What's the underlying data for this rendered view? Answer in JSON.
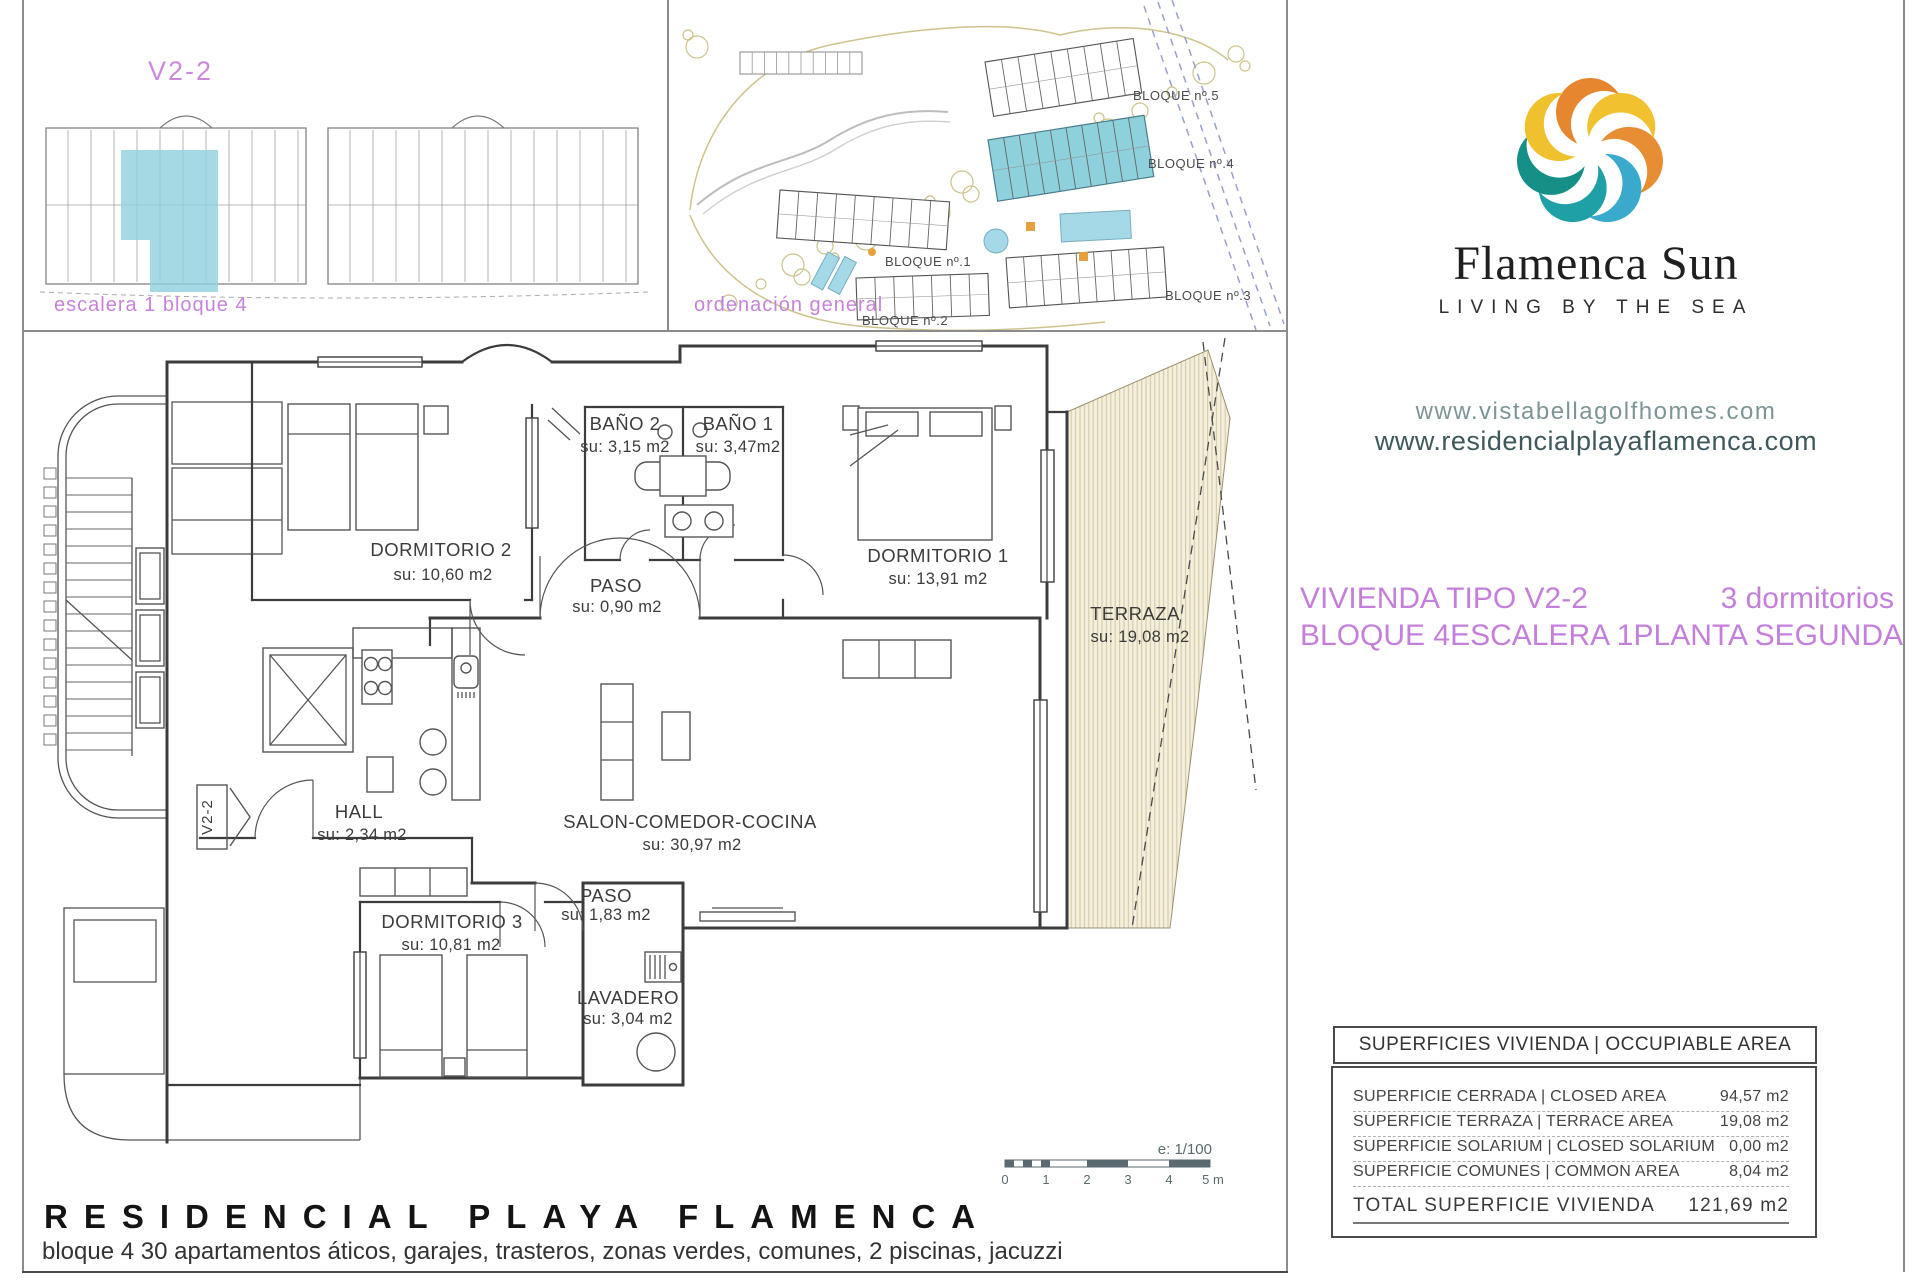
{
  "panel_unit": {
    "title": "V2-2",
    "caption": "escalera 1 bloque 4"
  },
  "panel_site": {
    "caption": "ordenación general",
    "blocks": {
      "b1": "BLOQUE nº.1",
      "b2": "BLOQUE nº.2",
      "b3": "BLOQUE nº.3",
      "b4": "BLOQUE nº.4",
      "b5": "BLOQUE nº.5"
    }
  },
  "brand": {
    "name": "Flamenca Sun",
    "tagline": "LIVING BY THE SEA",
    "url1": "www.vistabellagolfhomes.com",
    "url2": "www.residencialplayaflamenca.com"
  },
  "unit_info": {
    "type_label": "VIVIENDA TIPO V2-2",
    "bedrooms": "3 dormitorios",
    "block": "BLOQUE 4",
    "stair": "ESCALERA 1",
    "floor": "PLANTA SEGUNDA"
  },
  "rooms": [
    {
      "name": "DORMITORIO 2",
      "area": "su: 10,60 m2"
    },
    {
      "name": "BAÑO 2",
      "area": "su: 3,15 m2"
    },
    {
      "name": "BAÑO 1",
      "area": "su: 3,47m2"
    },
    {
      "name": "PASO",
      "area": "su: 0,90 m2"
    },
    {
      "name": "DORMITORIO 1",
      "area": "su: 13,91 m2"
    },
    {
      "name": "TERRAZA",
      "area": "su: 19,08 m2"
    },
    {
      "name": "HALL",
      "area": "su: 2,34 m2"
    },
    {
      "name": "SALON-COMEDOR-COCINA",
      "area": "su: 30,97 m2"
    },
    {
      "name": "DORMITORIO 3",
      "area": "su: 10,81 m2"
    },
    {
      "name": "PASO",
      "area": "su: 1,83 m2"
    },
    {
      "name": "LAVADERO",
      "area": "su: 3,04 m2"
    }
  ],
  "plan_marker": {
    "label": "V2-2"
  },
  "scale_bar": {
    "label": "e: 1/100",
    "ticks": [
      "0",
      "1",
      "2",
      "3",
      "4",
      "5 m"
    ]
  },
  "surface_table": {
    "header": "SUPERFICIES VIVIENDA | OCCUPIABLE AREA",
    "rows": [
      {
        "label": "SUPERFICIE CERRADA | CLOSED AREA",
        "value": "94,57 m2"
      },
      {
        "label": "SUPERFICIE TERRAZA  |  TERRACE AREA",
        "value": "19,08 m2"
      },
      {
        "label": "SUPERFICIE SOLARIUM | CLOSED SOLARIUM",
        "value": "0,00 m2"
      },
      {
        "label": "SUPERFICIE COMUNES | COMMON AREA",
        "value": "8,04 m2"
      }
    ],
    "total_label": "TOTAL SUPERFICIE VIVIENDA",
    "total_value": "121,69 m2"
  },
  "footer": {
    "title": "RESIDENCIAL PLAYA FLAMENCA",
    "subtitle": "bloque 4 30 apartamentos áticos, garajes, trasteros, zonas verdes, comunes, 2 piscinas, jacuzzi"
  },
  "colors": {
    "accent_purple": "#c47fdb",
    "highlight_teal": "#8fd0dd",
    "terrace_fill": "#f4f0dd",
    "url_light": "#7e9596",
    "url_dark": "#3f585c",
    "logo_palette": [
      "#E6862E",
      "#F1C12F",
      "#E78E35",
      "#39A9CC",
      "#1FA0A6",
      "#169086",
      "#EFC12F"
    ]
  }
}
